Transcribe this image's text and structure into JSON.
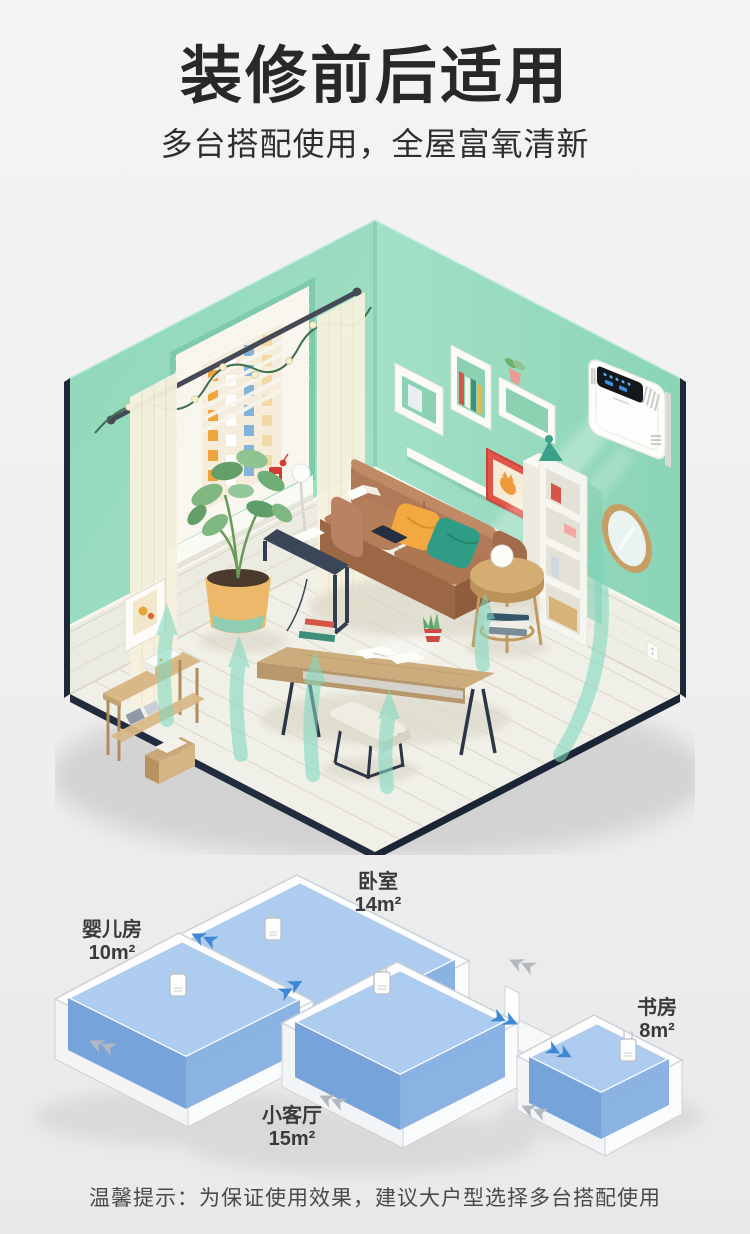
{
  "header": {
    "title": "装修前后适用",
    "subtitle": "多台搭配使用，全屋富氧清新"
  },
  "room_scene": {
    "colors": {
      "wall_mint": "#9adec2",
      "wainscot": "#ecebe1",
      "floor": "#f1f0e8",
      "base_edge": "#222c3e",
      "airflow": "#7fd8bf",
      "sofa": "#b07a57",
      "purifier_body": "#fdfdfc",
      "purifier_display": "#14171c",
      "purifier_led": "#57b0ff"
    }
  },
  "floor_plan": {
    "rooms": [
      {
        "name": "婴儿房",
        "area": "10m²"
      },
      {
        "name": "卧室",
        "area": "14m²"
      },
      {
        "name": "书房",
        "area": "8m²"
      },
      {
        "name": "小客厅",
        "area": "15m²"
      }
    ],
    "colors": {
      "block_top": "#abcbf0",
      "block_left": "#6f9fd8",
      "block_right": "#85b0e2",
      "inflow_arrow": "#3f88d4",
      "outflow_arrow": "#b3b8be"
    }
  },
  "footer": {
    "tip": "温馨提示：为保证使用效果，建议大户型选择多台搭配使用"
  }
}
